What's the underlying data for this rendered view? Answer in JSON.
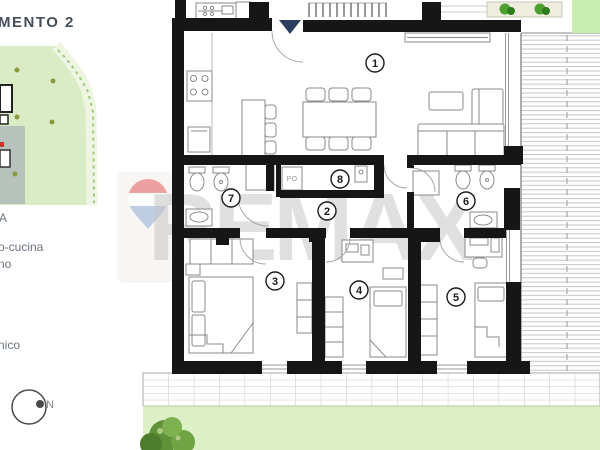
{
  "sidebar": {
    "title_fragment": "MENTO 2",
    "text_fragments": {
      "line1": "A",
      "line2": "o-cucina",
      "line3": "no",
      "line4": "nico"
    },
    "compass": {
      "label": "N"
    }
  },
  "watermark": {
    "brand_text": "REMAX",
    "balloon_red": "#ea9799",
    "balloon_blue": "#b7c9e0"
  },
  "floor_plan": {
    "room_numbers": {
      "living_kitchen": "1",
      "hallway": "2",
      "bedroom1": "3",
      "bedroom2": "4",
      "bedroom3": "5",
      "bathroom2": "6",
      "bathroom1": "7",
      "storage": "8"
    },
    "labels": {
      "appliance": "PO"
    }
  },
  "colors": {
    "wall": "#161616",
    "lawn_green": "#dcefc7",
    "corner_green": "#c9ecb0",
    "terrace_hatch": "#c6c6c6",
    "entrance_triangle": "#2c3e5d",
    "watermark_gray": "#c4c4c4"
  }
}
